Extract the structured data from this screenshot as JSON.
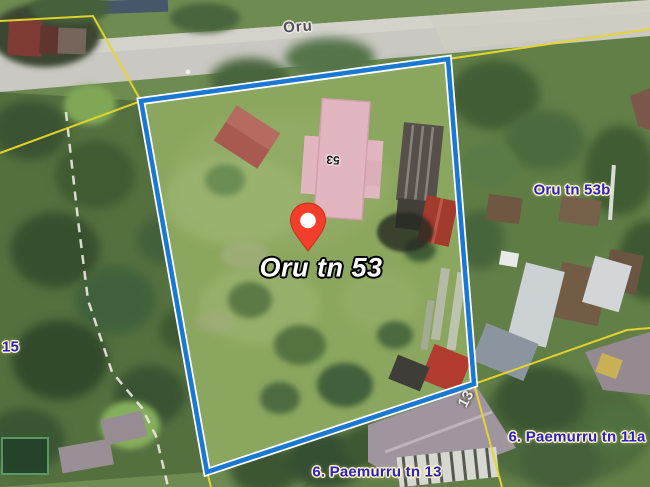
{
  "map": {
    "street_label": "Oru",
    "parcel": {
      "label": "Oru tn 53",
      "roof_number": "53",
      "corner_number": "13"
    },
    "neighbor_labels": {
      "east": "Oru tn 53b",
      "south": "6. Paemurru tn 13",
      "southeast": "6. Paemurru tn 11a",
      "west": "15"
    },
    "marker": {
      "icon": "map-pin-icon",
      "color": "#f23e2a"
    },
    "colors": {
      "parcel_boundary": "#1a78d2",
      "boundary_casing": "#ffffff",
      "cadastral_line": "#e8d72c",
      "address_label_text": "#2a20c8",
      "address_label_halo": "#fdf5bd",
      "road": "#c9c8c2"
    }
  }
}
